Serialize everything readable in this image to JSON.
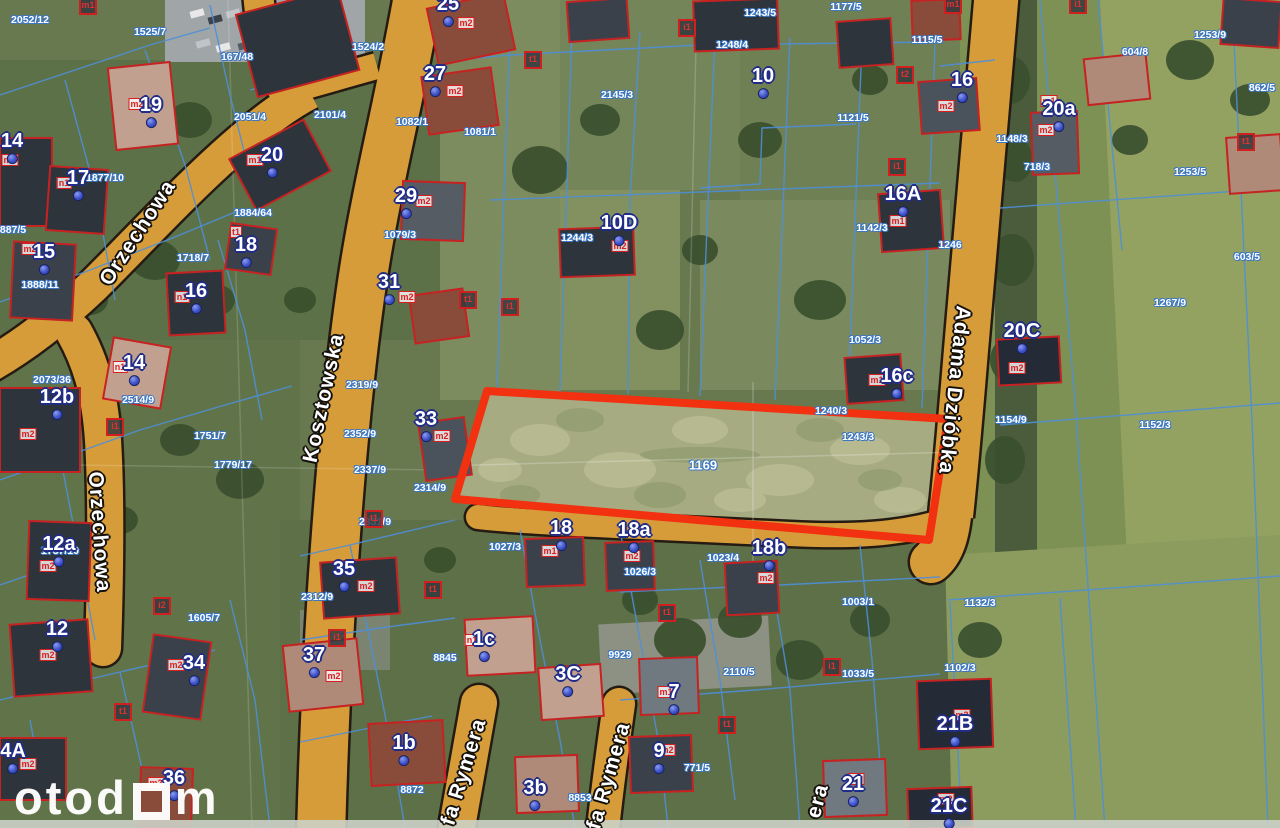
{
  "map": {
    "type": "cadastral-aerial-map",
    "highlight_parcel": {
      "number": "1169",
      "outline_color": "#f23110"
    },
    "colors": {
      "road": "#d79c3a",
      "road_outline": "#241b12",
      "cadastral_line": "#4e8fd8",
      "building_outline": "#c62222",
      "house_label": "#ffffff",
      "house_label_outline": "#202c86",
      "address_dot": "#3d52c9",
      "street_label": "#ffffff",
      "parcel_label": "#ffffff"
    },
    "streets": [
      {
        "name": "Orzechowa",
        "x": 138,
        "y": 233,
        "rot": -57
      },
      {
        "name": "Orzechowa",
        "x": 99,
        "y": 532,
        "rot": 86
      },
      {
        "name": "Kosztowska",
        "x": 324,
        "y": 398,
        "rot": -78
      },
      {
        "name": "Adama Dzióbka",
        "x": 954,
        "y": 390,
        "rot": 96
      },
      {
        "name": "fa Rymera",
        "x": 464,
        "y": 772,
        "rot": -73
      },
      {
        "name": "fa Rymera",
        "x": 609,
        "y": 776,
        "rot": -74
      },
      {
        "name": "era",
        "x": 818,
        "y": 801,
        "rot": -75
      }
    ],
    "houses": [
      {
        "number": "19",
        "x": 151,
        "y": 110
      },
      {
        "number": "14",
        "x": 12,
        "y": 146
      },
      {
        "number": "17",
        "x": 78,
        "y": 183
      },
      {
        "number": "20",
        "x": 272,
        "y": 160
      },
      {
        "number": "15",
        "x": 44,
        "y": 257
      },
      {
        "number": "18",
        "x": 246,
        "y": 250
      },
      {
        "number": "16",
        "x": 196,
        "y": 296
      },
      {
        "number": "14",
        "x": 134,
        "y": 368
      },
      {
        "number": "12b",
        "x": 57,
        "y": 402
      },
      {
        "number": "12a",
        "x": 59,
        "y": 549
      },
      {
        "number": "12",
        "x": 57,
        "y": 634
      },
      {
        "number": "34",
        "x": 194,
        "y": 668
      },
      {
        "number": "4A",
        "x": 13,
        "y": 756
      },
      {
        "number": "36",
        "x": 174,
        "y": 783
      },
      {
        "number": "25",
        "x": 448,
        "y": 9
      },
      {
        "number": "27",
        "x": 435,
        "y": 79
      },
      {
        "number": "29",
        "x": 406,
        "y": 201
      },
      {
        "number": "31",
        "x": 389,
        "y": 287
      },
      {
        "number": "33",
        "x": 426,
        "y": 424
      },
      {
        "number": "10D",
        "x": 619,
        "y": 228
      },
      {
        "number": "10",
        "x": 763,
        "y": 81
      },
      {
        "number": "16",
        "x": 962,
        "y": 85
      },
      {
        "number": "16A",
        "x": 903,
        "y": 199
      },
      {
        "number": "20a",
        "x": 1059,
        "y": 114
      },
      {
        "number": "20C",
        "x": 1022,
        "y": 336
      },
      {
        "number": "16c",
        "x": 897,
        "y": 381
      },
      {
        "number": "18",
        "x": 561,
        "y": 533
      },
      {
        "number": "18a",
        "x": 634,
        "y": 535
      },
      {
        "number": "18b",
        "x": 769,
        "y": 553
      },
      {
        "number": "35",
        "x": 344,
        "y": 574
      },
      {
        "number": "37",
        "x": 314,
        "y": 660
      },
      {
        "number": "1c",
        "x": 484,
        "y": 644
      },
      {
        "number": "3C",
        "x": 568,
        "y": 679
      },
      {
        "number": "1b",
        "x": 404,
        "y": 748
      },
      {
        "number": "3b",
        "x": 535,
        "y": 793
      },
      {
        "number": "7",
        "x": 674,
        "y": 697
      },
      {
        "number": "9",
        "x": 659,
        "y": 756
      },
      {
        "number": "21",
        "x": 853,
        "y": 789
      },
      {
        "number": "21B",
        "x": 955,
        "y": 729
      },
      {
        "number": "21C",
        "x": 949,
        "y": 811
      }
    ],
    "parcels": [
      {
        "number": "1169",
        "x": 703,
        "y": 465,
        "main": true
      },
      {
        "number": "2052/12",
        "x": 30,
        "y": 20
      },
      {
        "number": "1525/7",
        "x": 150,
        "y": 32
      },
      {
        "number": "167/48",
        "x": 237,
        "y": 57
      },
      {
        "number": "2051/4",
        "x": 250,
        "y": 117
      },
      {
        "number": "1877/10",
        "x": 105,
        "y": 178
      },
      {
        "number": "887/5",
        "x": 13,
        "y": 230
      },
      {
        "number": "1888/11",
        "x": 40,
        "y": 285
      },
      {
        "number": "1718/7",
        "x": 193,
        "y": 258
      },
      {
        "number": "1884/64",
        "x": 253,
        "y": 213
      },
      {
        "number": "2073/36",
        "x": 52,
        "y": 380
      },
      {
        "number": "2514/9",
        "x": 138,
        "y": 400
      },
      {
        "number": "1757/10",
        "x": 60,
        "y": 551
      },
      {
        "number": "1751/7",
        "x": 210,
        "y": 436
      },
      {
        "number": "1779/17",
        "x": 233,
        "y": 465
      },
      {
        "number": "1605/7",
        "x": 204,
        "y": 618
      },
      {
        "number": "1524/2",
        "x": 368,
        "y": 47
      },
      {
        "number": "2101/4",
        "x": 330,
        "y": 115
      },
      {
        "number": "2319/9",
        "x": 362,
        "y": 385
      },
      {
        "number": "2352/9",
        "x": 360,
        "y": 434
      },
      {
        "number": "2337/9",
        "x": 370,
        "y": 470
      },
      {
        "number": "2331/9",
        "x": 375,
        "y": 522
      },
      {
        "number": "2314/9",
        "x": 430,
        "y": 488
      },
      {
        "number": "2312/9",
        "x": 317,
        "y": 597
      },
      {
        "number": "1082/1",
        "x": 412,
        "y": 122
      },
      {
        "number": "1081/1",
        "x": 480,
        "y": 132
      },
      {
        "number": "1079/3",
        "x": 400,
        "y": 235
      },
      {
        "number": "2145/3",
        "x": 617,
        "y": 95
      },
      {
        "number": "1244/3",
        "x": 577,
        "y": 238
      },
      {
        "number": "1248/4",
        "x": 732,
        "y": 45
      },
      {
        "number": "1243/5",
        "x": 760,
        "y": 13
      },
      {
        "number": "1177/5",
        "x": 846,
        "y": 7
      },
      {
        "number": "1121/5",
        "x": 853,
        "y": 118
      },
      {
        "number": "1115/5",
        "x": 927,
        "y": 40
      },
      {
        "number": "1142/3",
        "x": 872,
        "y": 228
      },
      {
        "number": "1246",
        "x": 950,
        "y": 245
      },
      {
        "number": "1052/3",
        "x": 865,
        "y": 340
      },
      {
        "number": "1240/3",
        "x": 831,
        "y": 411
      },
      {
        "number": "1243/3",
        "x": 858,
        "y": 437
      },
      {
        "number": "1154/9",
        "x": 1011,
        "y": 420
      },
      {
        "number": "1253/9",
        "x": 1210,
        "y": 35
      },
      {
        "number": "604/8",
        "x": 1135,
        "y": 52
      },
      {
        "number": "862/5",
        "x": 1262,
        "y": 88
      },
      {
        "number": "1148/3",
        "x": 1012,
        "y": 139
      },
      {
        "number": "718/3",
        "x": 1037,
        "y": 167
      },
      {
        "number": "1253/5",
        "x": 1190,
        "y": 172
      },
      {
        "number": "603/5",
        "x": 1247,
        "y": 257
      },
      {
        "number": "1267/9",
        "x": 1170,
        "y": 303
      },
      {
        "number": "1152/3",
        "x": 1155,
        "y": 425
      },
      {
        "number": "1132/3",
        "x": 980,
        "y": 603
      },
      {
        "number": "1102/3",
        "x": 960,
        "y": 668
      },
      {
        "number": "1003/1",
        "x": 858,
        "y": 602
      },
      {
        "number": "1023/4",
        "x": 723,
        "y": 558
      },
      {
        "number": "1027/3",
        "x": 505,
        "y": 547
      },
      {
        "number": "1026/3",
        "x": 640,
        "y": 572
      },
      {
        "number": "1033/5",
        "x": 858,
        "y": 674
      },
      {
        "number": "2110/5",
        "x": 739,
        "y": 672
      },
      {
        "number": "771/5",
        "x": 697,
        "y": 768
      },
      {
        "number": "8845",
        "x": 445,
        "y": 658
      },
      {
        "number": "9929",
        "x": 620,
        "y": 655
      },
      {
        "number": "8872",
        "x": 412,
        "y": 790
      },
      {
        "number": "8853",
        "x": 580,
        "y": 798
      }
    ],
    "building_codes": [
      {
        "text": "m2",
        "x": 137,
        "y": 104,
        "kind": "code"
      },
      {
        "text": "m3",
        "x": 10,
        "y": 160,
        "kind": "code"
      },
      {
        "text": "n1",
        "x": 64,
        "y": 183,
        "kind": "code"
      },
      {
        "text": "m1",
        "x": 255,
        "y": 160,
        "kind": "code"
      },
      {
        "text": "m2",
        "x": 30,
        "y": 249,
        "kind": "code"
      },
      {
        "text": "t1",
        "x": 236,
        "y": 232,
        "kind": "code"
      },
      {
        "text": "n1",
        "x": 182,
        "y": 297,
        "kind": "code"
      },
      {
        "text": "n1",
        "x": 120,
        "y": 367,
        "kind": "code"
      },
      {
        "text": "m2",
        "x": 28,
        "y": 434,
        "kind": "code"
      },
      {
        "text": "m2",
        "x": 48,
        "y": 566,
        "kind": "code"
      },
      {
        "text": "m2",
        "x": 48,
        "y": 655,
        "kind": "code"
      },
      {
        "text": "m2",
        "x": 176,
        "y": 665,
        "kind": "code"
      },
      {
        "text": "m2",
        "x": 28,
        "y": 764,
        "kind": "code"
      },
      {
        "text": "m2",
        "x": 156,
        "y": 783,
        "kind": "code"
      },
      {
        "text": "m2",
        "x": 466,
        "y": 23,
        "kind": "code"
      },
      {
        "text": "m2",
        "x": 455,
        "y": 91,
        "kind": "code"
      },
      {
        "text": "m2",
        "x": 424,
        "y": 201,
        "kind": "code"
      },
      {
        "text": "m2",
        "x": 407,
        "y": 297,
        "kind": "code"
      },
      {
        "text": "m2",
        "x": 442,
        "y": 436,
        "kind": "code"
      },
      {
        "text": "m2",
        "x": 620,
        "y": 246,
        "kind": "code"
      },
      {
        "text": "m2",
        "x": 946,
        "y": 106,
        "kind": "code"
      },
      {
        "text": "m1",
        "x": 898,
        "y": 221,
        "kind": "code"
      },
      {
        "text": "m2",
        "x": 1046,
        "y": 130,
        "kind": "code"
      },
      {
        "text": "m1",
        "x": 1049,
        "y": 101,
        "kind": "code"
      },
      {
        "text": "m2",
        "x": 1017,
        "y": 368,
        "kind": "code"
      },
      {
        "text": "m1",
        "x": 877,
        "y": 380,
        "kind": "code"
      },
      {
        "text": "m1",
        "x": 550,
        "y": 551,
        "kind": "code"
      },
      {
        "text": "m2",
        "x": 632,
        "y": 556,
        "kind": "code"
      },
      {
        "text": "m2",
        "x": 766,
        "y": 578,
        "kind": "code"
      },
      {
        "text": "m2",
        "x": 366,
        "y": 586,
        "kind": "code"
      },
      {
        "text": "m2",
        "x": 334,
        "y": 676,
        "kind": "code"
      },
      {
        "text": "n1",
        "x": 472,
        "y": 640,
        "kind": "code"
      },
      {
        "text": "m1",
        "x": 666,
        "y": 692,
        "kind": "code"
      },
      {
        "text": "m2",
        "x": 667,
        "y": 750,
        "kind": "code"
      },
      {
        "text": "m2",
        "x": 856,
        "y": 779,
        "kind": "code"
      },
      {
        "text": "m2",
        "x": 962,
        "y": 715,
        "kind": "code"
      },
      {
        "text": "m2",
        "x": 946,
        "y": 799,
        "kind": "code"
      },
      {
        "text": "m1",
        "x": 88,
        "y": 6,
        "kind": "shed"
      },
      {
        "text": "m1",
        "x": 953,
        "y": 5,
        "kind": "shed"
      },
      {
        "text": "t1",
        "x": 533,
        "y": 60,
        "kind": "shed"
      },
      {
        "text": "t1",
        "x": 468,
        "y": 300,
        "kind": "shed"
      },
      {
        "text": "i1",
        "x": 510,
        "y": 307,
        "kind": "shed"
      },
      {
        "text": "i1",
        "x": 115,
        "y": 427,
        "kind": "shed"
      },
      {
        "text": "t1",
        "x": 433,
        "y": 590,
        "kind": "shed"
      },
      {
        "text": "i1",
        "x": 337,
        "y": 638,
        "kind": "shed"
      },
      {
        "text": "t1",
        "x": 727,
        "y": 725,
        "kind": "shed"
      },
      {
        "text": "i1",
        "x": 832,
        "y": 667,
        "kind": "shed"
      },
      {
        "text": "t1",
        "x": 667,
        "y": 613,
        "kind": "shed"
      },
      {
        "text": "t1",
        "x": 123,
        "y": 712,
        "kind": "shed"
      },
      {
        "text": "i1",
        "x": 687,
        "y": 28,
        "kind": "shed"
      },
      {
        "text": "i1",
        "x": 1078,
        "y": 5,
        "kind": "shed"
      },
      {
        "text": "t1",
        "x": 1246,
        "y": 142,
        "kind": "shed"
      },
      {
        "text": "t1",
        "x": 374,
        "y": 519,
        "kind": "shed"
      },
      {
        "text": "i1",
        "x": 897,
        "y": 167,
        "kind": "shed"
      },
      {
        "text": "i2",
        "x": 162,
        "y": 606,
        "kind": "shed"
      },
      {
        "text": "t2",
        "x": 905,
        "y": 75,
        "kind": "shed"
      }
    ],
    "watermark": {
      "left": "otod",
      "right": "m"
    }
  }
}
